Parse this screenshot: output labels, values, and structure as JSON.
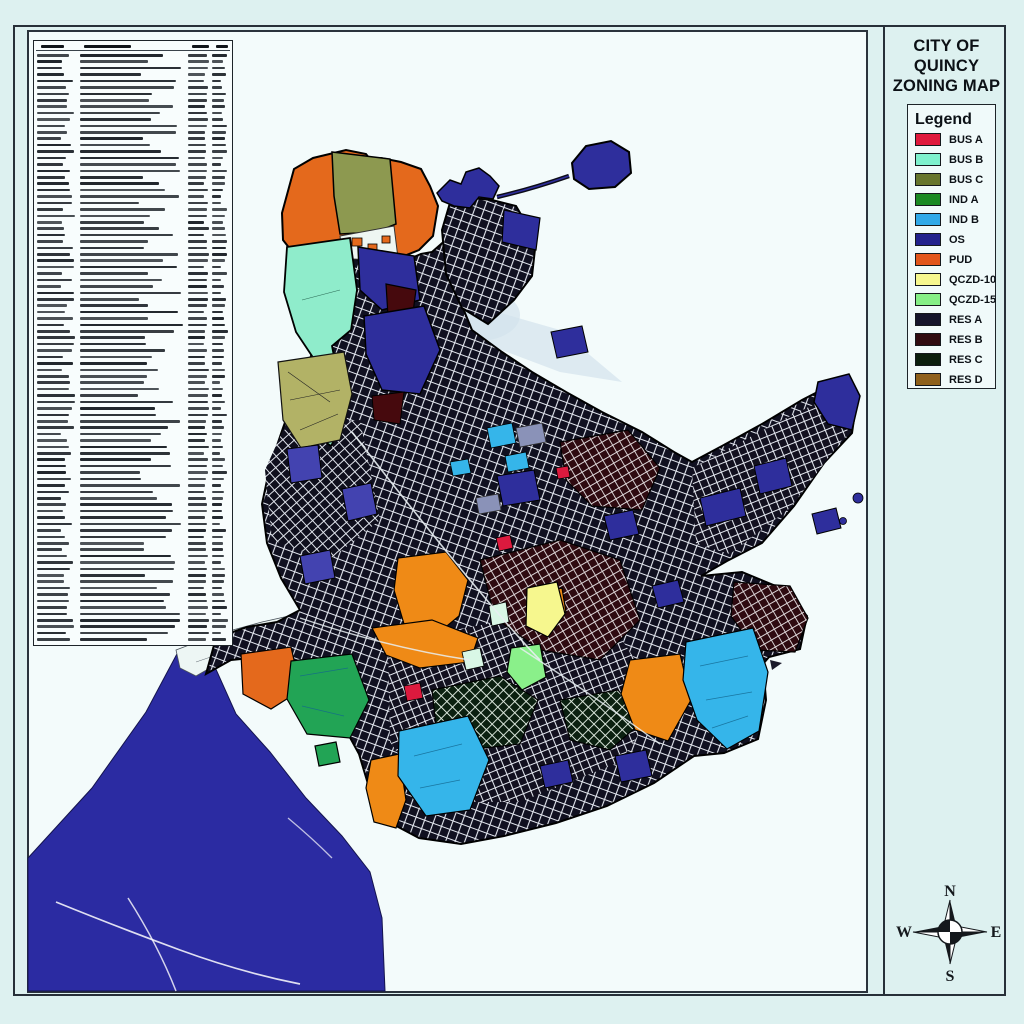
{
  "title_block": {
    "line1": "CITY OF QUINCY",
    "line2": "ZONING MAP"
  },
  "legend": {
    "title": "Legend",
    "items": [
      {
        "label": "BUS A",
        "color": "#df1a3d"
      },
      {
        "label": "BUS B",
        "color": "#7ef1cd"
      },
      {
        "label": "BUS C",
        "color": "#67762d"
      },
      {
        "label": "IND A",
        "color": "#1a8a22"
      },
      {
        "label": "IND B",
        "color": "#30a9e8"
      },
      {
        "label": "OS",
        "color": "#22228c"
      },
      {
        "label": "PUD",
        "color": "#e2561b"
      },
      {
        "label": "QCZD-10",
        "color": "#f6f78e"
      },
      {
        "label": "QCZD-15",
        "color": "#86ef86"
      },
      {
        "label": "RES A",
        "color": "#15152b"
      },
      {
        "label": "RES B",
        "color": "#300c11"
      },
      {
        "label": "RES C",
        "color": "#0b1f0d"
      },
      {
        "label": "RES D",
        "color": "#8f611c"
      }
    ]
  },
  "compass": {
    "north": "N",
    "south": "S",
    "east": "E",
    "west": "W"
  },
  "amendments_table": {
    "legible": false,
    "row_count": 92,
    "column_count": 4
  },
  "map": {
    "water_color": "#2b2ba2",
    "land_texture_base": "#101020",
    "street_color": "#e3e7ef",
    "background": "#f3fbfb"
  }
}
